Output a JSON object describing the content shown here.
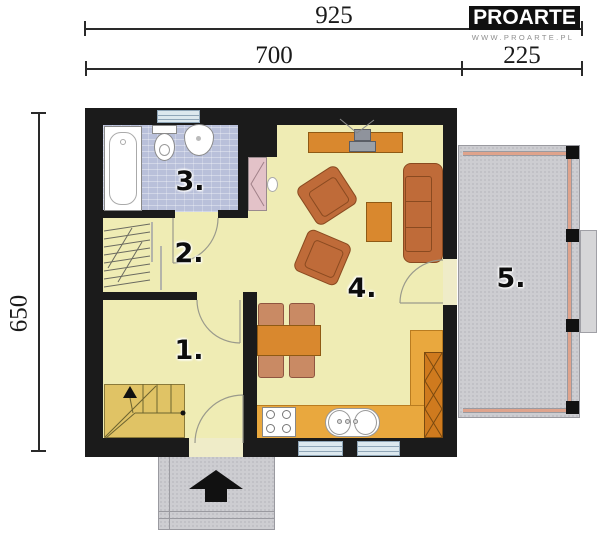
{
  "dimensions": {
    "overall_width": "925",
    "house_width": "700",
    "terrace_width": "225",
    "overall_depth": "650"
  },
  "logo": {
    "brand": "PROARTE",
    "website": "WWW.PROARTE.PL"
  },
  "rooms": [
    {
      "label": "1."
    },
    {
      "label": "2."
    },
    {
      "label": "3."
    },
    {
      "label": "4."
    },
    {
      "label": "5."
    }
  ],
  "colors": {
    "wall": "#1b1b1b",
    "floor": "#efecb4",
    "bathroom_floor": "#b9c0da",
    "stairs": "#e0c365",
    "kitchen_counter": "#e9a83e",
    "wood_furniture": "#d9882e",
    "sofa": "#bf6b39",
    "dining_chair": "#c98a64",
    "fireplace": "#e3c2c8",
    "terrace_concrete": "#cdcdd1",
    "window": "#dce8ee"
  }
}
